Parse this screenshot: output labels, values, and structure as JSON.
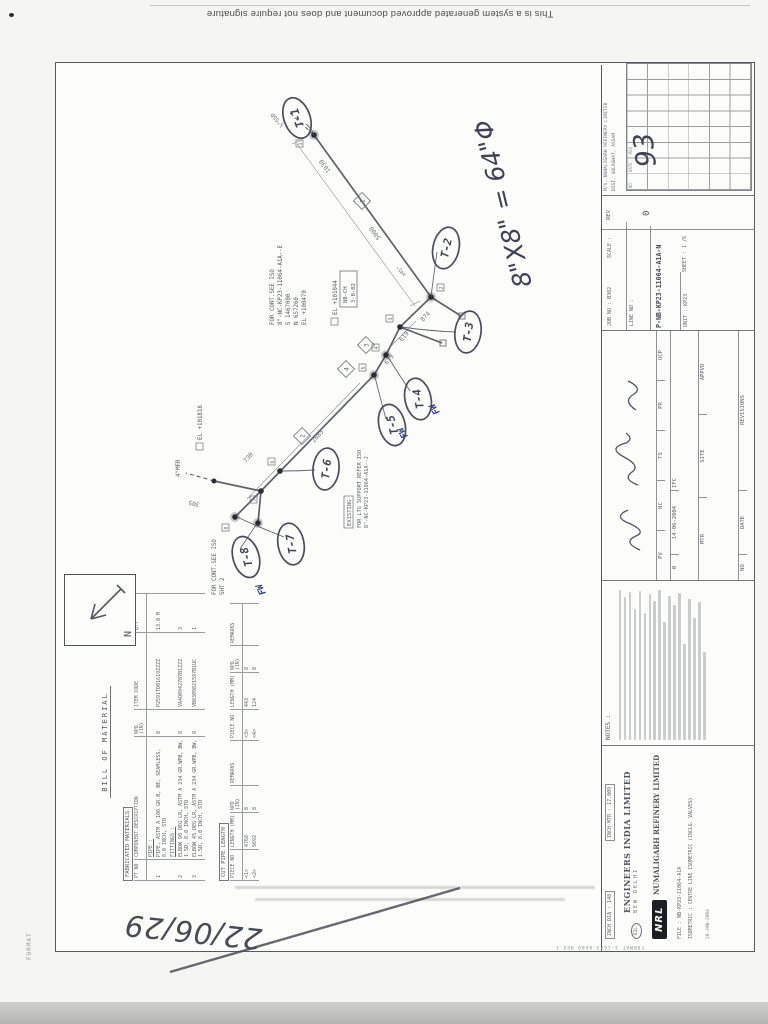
{
  "scan": {
    "system_text": "This is a system generated approved document and does not require signature",
    "handwritten_date": "22/06/29",
    "edge_label": "FORMAT"
  },
  "iso": {
    "balloons": [
      {
        "label": "T-1"
      },
      {
        "label": "T-2"
      },
      {
        "label": "T-3"
      },
      {
        "label": "T-4"
      },
      {
        "label": "T-5"
      },
      {
        "label": "T-6"
      },
      {
        "label": "T-7"
      },
      {
        "label": "T-8"
      }
    ],
    "fw": [
      "FW",
      "FW",
      "FW"
    ],
    "hand_size_note": "8\"X8\" = 64\"Φ",
    "north_label": "N",
    "stub_label": "½\"SSD",
    "mfr_label": "4\"MFR",
    "angle_label": "x45°",
    "cont_a": [
      "FOR CONT.SEE ISO",
      "8\"-NC-KP23-11064-A1A--E",
      "S 1467000",
      "N 657260",
      "EL +100470"
    ],
    "cont_b": [
      "FOR CONT.SEE ISO",
      "SHT 2"
    ],
    "support_note": [
      "EXISTING",
      "FOR LTG SUPPORT REFER ISO",
      "8\"-NC-KP23-11064-A1A--J"
    ],
    "support_tag": [
      "NB-CH",
      "3-B-02"
    ],
    "elev_a": "EL +101044",
    "elev_b": "EL +101818",
    "dims": {
      "run1a": "5000",
      "run1b": "1030",
      "offset": "874",
      "s619a": "619",
      "s619b": "619",
      "run2": "2885",
      "s730": "730",
      "riser": "305"
    },
    "piece_marks": [
      "1",
      "2",
      "3",
      "4"
    ],
    "weld_marks": [
      "1",
      "2",
      "3",
      "4",
      "5",
      "6",
      "7",
      "8"
    ]
  },
  "bom": {
    "title": "BILL OF MATERIAL",
    "section_fabricated": "FABRICATED MATERIALS",
    "cols": {
      "pt": "PT NO",
      "desc": "COMPONENT DESCRIPTION",
      "npd": "NPD (IN)",
      "code": "ITEM CODE",
      "qty": "QTY"
    },
    "group_pipe": "PIPE :",
    "group_fittings": "FITTINGS :",
    "rows": [
      {
        "pt": "1",
        "desc": "PIPE, ASTM A 106 GR.B, BE, SEAMLESS, 8.0 INCH, STD",
        "npd": "8",
        "code": "P2591TD01619ZZZZ",
        "qty": "13.0 M"
      },
      {
        "pt": "2",
        "desc": "ELBOW 90 DEG LR, ASTM A 234 GR.WPB, BW, 1.5D, 8.0 INCH, STD",
        "npd": "8",
        "code": "VA4Q0942707B1ZZZ",
        "qty": "3"
      },
      {
        "pt": "3",
        "desc": "ELBOW 45 DEG LR, ASTM A 234 GR.WPB, BW, 1.5D, 8.0 INCH, STD",
        "npd": "8",
        "code": "VB0309821597B1UC",
        "qty": "1"
      }
    ],
    "cut": {
      "title": "CUT PIPE LENGTH",
      "cols": {
        "piece": "PIECE NO",
        "len": "LENGTH (MM)",
        "npd": "NPD (IN)",
        "rem": "REMARKS"
      },
      "rows": [
        {
          "p1": "<1>",
          "l1": "4768",
          "n1": "8",
          "p2": "<3>",
          "l2": "443",
          "n2": "8"
        },
        {
          "p1": "<2>",
          "l1": "5692",
          "n1": "8",
          "p2": "<4>",
          "l2": "124",
          "n2": "8"
        }
      ]
    }
  },
  "title_block": {
    "inch_dia": "INCH DIA : 148",
    "inch_mtr": "INCH-MTR : 17.009",
    "eil_badge": "EIL",
    "eil_name": "ENGINEERS INDIA LIMITED",
    "eil_city": "NEW DELHI",
    "nrl_logo": "NRL",
    "nrl_name": "NUMALIGARH REFINERY LIMITED",
    "file_line": "FILE : NB-KP23-11064-A1A",
    "title_line": "ISOMETRIC : CENTRE LINE ISOMETRIC (INCLG. VALVES)",
    "format_line": "FORMAT 3-1643-0609 REV.1",
    "date_line": "20-JAN-2004",
    "notes_title": "NOTES :",
    "client_l1": "M/S. NUMALIGARH REFINERY LIMITED",
    "client_l2": "DIST. GOLAGHAT, ASSAM",
    "appr": {
      "rev_no": "0",
      "rev_date": "14-06-2004",
      "rev_desc": "IFC",
      "sig_cols": [
        "PV",
        "NC",
        "TS",
        "PR",
        "UCP"
      ],
      "sub_cols": [
        "MTR",
        "SITE",
        "APPVD"
      ],
      "lbl_no": "NO",
      "lbl_date": "DATE",
      "lbl_rev": "REVISIONS"
    },
    "job_no": "JOB NO : B302",
    "scale_lbl": "SCALE :",
    "line_lbl": "LINE NO :",
    "drg_no": "P-NB-KP23-11064-A1A-N",
    "unit": "UNIT : KP23",
    "sheet": "SHEET : 1 /6",
    "rev_lbl": "REV",
    "rev_val": "0",
    "grid_labels": [
      "NO",
      "DATE",
      "REV"
    ],
    "grid_hand": "93"
  }
}
